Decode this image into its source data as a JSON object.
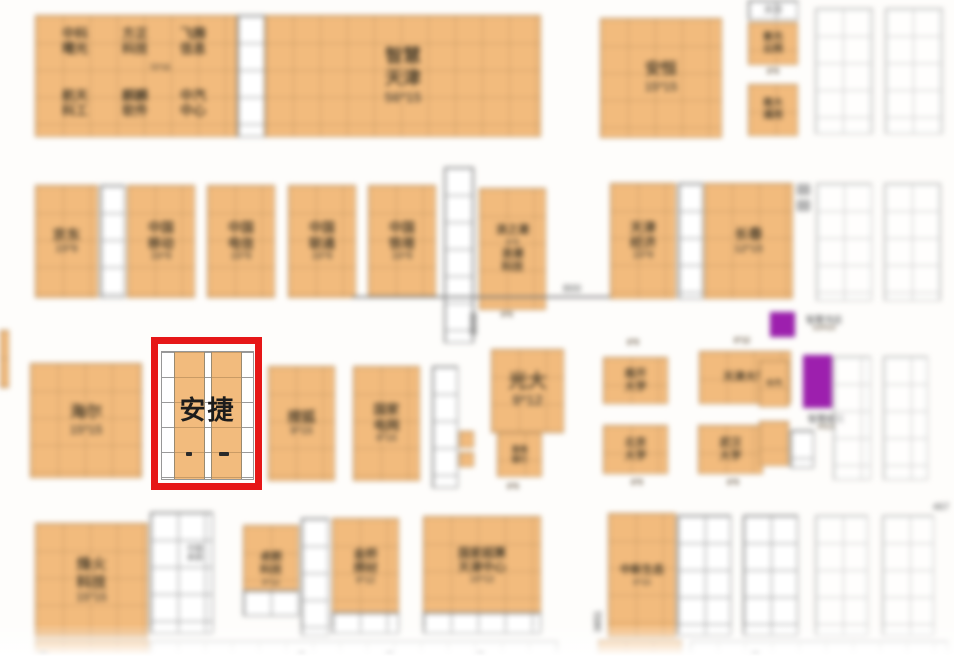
{
  "title": "exhibition-floor-plan",
  "highlight": {
    "company": "安捷",
    "frame_color": "#e61717"
  },
  "colors": {
    "booth_orange": "#f2bb7d",
    "empty_white": "#ffffff",
    "service_purple": "#9d1fae",
    "highlight_red": "#e61717",
    "label_dark": "#50432f",
    "dim_gray": "#8b8b8b"
  },
  "booths": [
    {
      "id": "group-topleft",
      "kind": "orange",
      "x": 35,
      "y": 15,
      "w": 202,
      "h": 122,
      "fs": 13,
      "lines": []
    },
    {
      "id": "band-topleft",
      "kind": "txt",
      "x": 100,
      "y": 60,
      "w": 120,
      "h": 16,
      "fs": 10,
      "cls": "gray-t",
      "lines": [
        "72*15"
      ]
    },
    {
      "id": "zhongke-shuguang",
      "kind": "txt",
      "x": 52,
      "y": 20,
      "w": 46,
      "h": 42,
      "fs": 13,
      "lines": [
        "中科",
        "曙光"
      ]
    },
    {
      "id": "fangzheng-keji",
      "kind": "txt",
      "x": 112,
      "y": 20,
      "w": 46,
      "h": 42,
      "fs": 13,
      "lines": [
        "方正",
        "科技"
      ]
    },
    {
      "id": "feiteng-xinxi",
      "kind": "txt",
      "x": 168,
      "y": 20,
      "w": 50,
      "h": 42,
      "fs": 13,
      "lines": [
        "飞腾",
        "信息"
      ]
    },
    {
      "id": "hangtian-kegong",
      "kind": "txt",
      "x": 52,
      "y": 82,
      "w": 46,
      "h": 42,
      "fs": 13,
      "lines": [
        "航天",
        "科工"
      ]
    },
    {
      "id": "qilin-ruanjian",
      "kind": "txt",
      "x": 112,
      "y": 82,
      "w": 46,
      "h": 42,
      "fs": 13,
      "lines": [
        "麒麟",
        "软件"
      ]
    },
    {
      "id": "zhongqi-zhongxin",
      "kind": "txt",
      "x": 168,
      "y": 82,
      "w": 50,
      "h": 42,
      "fs": 13,
      "lines": [
        "中汽",
        "中心"
      ]
    },
    {
      "id": "empty-col-1",
      "kind": "white",
      "x": 237,
      "y": 15,
      "w": 28,
      "h": 122,
      "lines": []
    },
    {
      "id": "zhihui-tianjin",
      "kind": "orange",
      "x": 265,
      "y": 15,
      "w": 276,
      "h": 122,
      "fs": 18,
      "lines": [
        "智慧",
        "天津",
        "56*15"
      ]
    },
    {
      "id": "anheng",
      "kind": "orange",
      "x": 600,
      "y": 18,
      "w": 122,
      "h": 120,
      "fs": 16,
      "lines": [
        "安恒",
        "15*15"
      ]
    },
    {
      "id": "tianhe",
      "kind": "white",
      "x": 748,
      "y": 0,
      "w": 50,
      "h": 20,
      "fs": 9,
      "cls": "gray-t",
      "lines": [
        "天河"
      ]
    },
    {
      "id": "ziguang-yunwang",
      "kind": "orange",
      "x": 748,
      "y": 22,
      "w": 50,
      "h": 43,
      "fs": 10,
      "lines": [
        "紫光",
        "云网"
      ]
    },
    {
      "id": "label-6x9-top",
      "kind": "txt",
      "x": 756,
      "y": 64,
      "w": 34,
      "h": 16,
      "fs": 10,
      "cls": "gray-t",
      "lines": [
        "6*9"
      ]
    },
    {
      "id": "nanda-tongyong",
      "kind": "orange",
      "x": 748,
      "y": 84,
      "w": 50,
      "h": 52,
      "fs": 10,
      "lines": [
        "南大",
        "通用"
      ]
    },
    {
      "id": "empty-top-1",
      "kind": "white faded",
      "x": 815,
      "y": 8,
      "w": 58,
      "h": 126,
      "lines": []
    },
    {
      "id": "empty-top-2",
      "kind": "white faded",
      "x": 885,
      "y": 8,
      "w": 58,
      "h": 126,
      "lines": []
    },
    {
      "id": "jingdong",
      "kind": "orange",
      "x": 35,
      "y": 185,
      "w": 63,
      "h": 113,
      "fs": 14,
      "lines": [
        "京东",
        "15*9"
      ]
    },
    {
      "id": "empty-col-2",
      "kind": "white",
      "x": 100,
      "y": 185,
      "w": 25,
      "h": 113,
      "lines": []
    },
    {
      "id": "china-mobile",
      "kind": "orange",
      "x": 127,
      "y": 185,
      "w": 68,
      "h": 113,
      "fs": 13,
      "lines": [
        "中国",
        "移动",
        "15*9"
      ]
    },
    {
      "id": "china-telecom",
      "kind": "orange",
      "x": 207,
      "y": 185,
      "w": 68,
      "h": 113,
      "fs": 13,
      "lines": [
        "中国",
        "电信",
        "15*9"
      ]
    },
    {
      "id": "china-unicom",
      "kind": "orange",
      "x": 288,
      "y": 185,
      "w": 68,
      "h": 113,
      "fs": 13,
      "lines": [
        "中国",
        "联通",
        "15*9"
      ]
    },
    {
      "id": "china-tower",
      "kind": "orange",
      "x": 368,
      "y": 185,
      "w": 68,
      "h": 113,
      "fs": 13,
      "lines": [
        "中国",
        "铁塔",
        "15*9"
      ]
    },
    {
      "id": "ladder-1",
      "kind": "white",
      "x": 444,
      "y": 167,
      "w": 30,
      "h": 176,
      "lines": []
    },
    {
      "id": "langchao",
      "kind": "orange",
      "x": 479,
      "y": 188,
      "w": 67,
      "h": 122,
      "fs": 11,
      "lines": [
        "浪之潮",
        "6*9",
        "浪潮",
        "科技"
      ]
    },
    {
      "id": "label-6x6-a",
      "kind": "txt",
      "x": 492,
      "y": 308,
      "w": 30,
      "h": 14,
      "fs": 10,
      "cls": "gray-t",
      "lines": [
        "6*6"
      ]
    },
    {
      "id": "dim-line-800",
      "kind": "hline",
      "x": 352,
      "y": 296,
      "w": 276,
      "h": 2,
      "lines": []
    },
    {
      "id": "dim-800",
      "kind": "txt",
      "x": 556,
      "y": 283,
      "w": 32,
      "h": 12,
      "fs": 11,
      "cls": "gray-t",
      "lines": [
        "800"
      ]
    },
    {
      "id": "dim-8000",
      "kind": "vtext",
      "x": 468,
      "y": 300,
      "w": 14,
      "h": 48,
      "lines": [
        "8000"
      ]
    },
    {
      "id": "tianjin-jingji",
      "kind": "orange",
      "x": 610,
      "y": 183,
      "w": 66,
      "h": 116,
      "fs": 13,
      "lines": [
        "天津",
        "经济",
        "15*9"
      ]
    },
    {
      "id": "empty-col-3",
      "kind": "white",
      "x": 678,
      "y": 183,
      "w": 25,
      "h": 116,
      "lines": []
    },
    {
      "id": "changchun",
      "kind": "orange",
      "x": 704,
      "y": 183,
      "w": 89,
      "h": 116,
      "fs": 14,
      "lines": [
        "长春",
        "12*15"
      ]
    },
    {
      "id": "tiny-gray-1",
      "kind": "grayblk",
      "x": 797,
      "y": 184,
      "w": 13,
      "h": 11,
      "lines": []
    },
    {
      "id": "tiny-gray-2",
      "kind": "grayblk",
      "x": 797,
      "y": 200,
      "w": 13,
      "h": 11,
      "lines": []
    },
    {
      "id": "empty-mid-1",
      "kind": "white faded",
      "x": 816,
      "y": 183,
      "w": 56,
      "h": 118,
      "lines": []
    },
    {
      "id": "empty-mid-2",
      "kind": "white faded",
      "x": 884,
      "y": 183,
      "w": 57,
      "h": 118,
      "lines": []
    },
    {
      "id": "edge-sliver",
      "kind": "orange",
      "x": 0,
      "y": 330,
      "w": 9,
      "h": 58,
      "lines": []
    },
    {
      "id": "haier",
      "kind": "orange",
      "x": 30,
      "y": 363,
      "w": 112,
      "h": 115,
      "fs": 16,
      "lines": [
        "海尔",
        "15*15"
      ]
    },
    {
      "id": "souhu",
      "kind": "orange",
      "x": 268,
      "y": 366,
      "w": 67,
      "h": 115,
      "fs": 14,
      "lines": [
        "搜狐",
        "9*15"
      ]
    },
    {
      "id": "guojia-dianwang",
      "kind": "orange",
      "x": 353,
      "y": 366,
      "w": 67,
      "h": 115,
      "fs": 13,
      "lines": [
        "国家",
        "电网",
        "9*15"
      ]
    },
    {
      "id": "ladder-2",
      "kind": "white",
      "x": 432,
      "y": 366,
      "w": 26,
      "h": 122,
      "lines": []
    },
    {
      "id": "small-booth-1",
      "kind": "orange",
      "x": 459,
      "y": 431,
      "w": 15,
      "h": 17,
      "lines": []
    },
    {
      "id": "small-booth-2",
      "kind": "orange",
      "x": 459,
      "y": 452,
      "w": 15,
      "h": 15,
      "lines": []
    },
    {
      "id": "guangda",
      "kind": "orange",
      "x": 491,
      "y": 349,
      "w": 73,
      "h": 84,
      "fs": 19,
      "lines": [
        "光大",
        "9*12"
      ]
    },
    {
      "id": "guangda-sub",
      "kind": "orange",
      "x": 497,
      "y": 432,
      "w": 45,
      "h": 45,
      "fs": 8,
      "lines": [
        "渤海",
        "银行"
      ]
    },
    {
      "id": "label-6x6-b",
      "kind": "txt",
      "x": 498,
      "y": 480,
      "w": 30,
      "h": 13,
      "fs": 10,
      "cls": "gray-t",
      "lines": [
        "6*6"
      ]
    },
    {
      "id": "label-6x9-a",
      "kind": "txt",
      "x": 618,
      "y": 336,
      "w": 30,
      "h": 13,
      "fs": 10,
      "cls": "gray-t",
      "lines": [
        "6*9"
      ]
    },
    {
      "id": "nankai-daxue",
      "kind": "orange",
      "x": 603,
      "y": 357,
      "w": 65,
      "h": 47,
      "fs": 11,
      "lines": [
        "南开",
        "大学"
      ]
    },
    {
      "id": "label-6x12",
      "kind": "txt",
      "x": 724,
      "y": 334,
      "w": 36,
      "h": 13,
      "fs": 10,
      "cls": "gray-t",
      "lines": [
        "6*12"
      ]
    },
    {
      "id": "tianjin-daxue",
      "kind": "orange",
      "x": 699,
      "y": 351,
      "w": 92,
      "h": 53,
      "fs": 11,
      "lines": [
        "天津大学"
      ]
    },
    {
      "id": "beijing-daxue",
      "kind": "orange",
      "x": 603,
      "y": 425,
      "w": 65,
      "h": 49,
      "fs": 11,
      "lines": [
        "北京",
        "大学"
      ]
    },
    {
      "id": "label-6x9-b",
      "kind": "txt",
      "x": 622,
      "y": 476,
      "w": 30,
      "h": 13,
      "fs": 10,
      "cls": "gray-t",
      "lines": [
        "6*9"
      ]
    },
    {
      "id": "wuhan-daxue",
      "kind": "orange",
      "x": 698,
      "y": 425,
      "w": 65,
      "h": 49,
      "fs": 11,
      "lines": [
        "武汉",
        "大学"
      ]
    },
    {
      "id": "label-6x9-c",
      "kind": "txt",
      "x": 718,
      "y": 476,
      "w": 30,
      "h": 13,
      "fs": 10,
      "cls": "gray-t",
      "lines": [
        "6*9"
      ]
    },
    {
      "id": "zhongqi-east",
      "kind": "orange",
      "x": 759,
      "y": 360,
      "w": 30,
      "h": 47,
      "fs": 8,
      "lines": [
        "中汽"
      ]
    },
    {
      "id": "east-sub",
      "kind": "orange",
      "x": 759,
      "y": 421,
      "w": 30,
      "h": 45,
      "lines": []
    },
    {
      "id": "purple-bookstore",
      "kind": "purple",
      "x": 770,
      "y": 312,
      "w": 25,
      "h": 25,
      "lines": []
    },
    {
      "id": "bookstore-label",
      "kind": "txt",
      "x": 797,
      "y": 310,
      "w": 54,
      "h": 28,
      "fs": 9,
      "cls": "gray-t",
      "lines": [
        "智慧书店",
        "3.5*3.5"
      ]
    },
    {
      "id": "purple-post",
      "kind": "purple",
      "x": 803,
      "y": 355,
      "w": 29,
      "h": 53,
      "lines": []
    },
    {
      "id": "post-label",
      "kind": "txt",
      "x": 800,
      "y": 409,
      "w": 52,
      "h": 28,
      "fs": 9,
      "cls": "gray-t",
      "lines": [
        "智慧邮局",
        "4*2.5"
      ]
    },
    {
      "id": "small-white",
      "kind": "white",
      "x": 790,
      "y": 430,
      "w": 24,
      "h": 38,
      "lines": []
    },
    {
      "id": "empty-r3-1",
      "kind": "white faded",
      "x": 833,
      "y": 356,
      "w": 38,
      "h": 124,
      "lines": []
    },
    {
      "id": "empty-r3-2",
      "kind": "white faded",
      "x": 883,
      "y": 356,
      "w": 45,
      "h": 124,
      "lines": []
    },
    {
      "id": "fenghuo-keji",
      "kind": "orange",
      "x": 35,
      "y": 523,
      "w": 113,
      "h": 115,
      "fs": 15,
      "lines": [
        "烽火",
        "科技",
        "15*15"
      ]
    },
    {
      "id": "empty-b1",
      "kind": "white",
      "x": 150,
      "y": 512,
      "w": 63,
      "h": 122,
      "lines": []
    },
    {
      "id": "zhongguo-xitong",
      "kind": "txt",
      "x": 174,
      "y": 539,
      "w": 42,
      "h": 28,
      "fs": 8,
      "cls": "gray-t",
      "lines": [
        "中国",
        "系统"
      ]
    },
    {
      "id": "zhuolang-keji",
      "kind": "orange",
      "x": 243,
      "y": 525,
      "w": 56,
      "h": 88,
      "fs": 11,
      "lines": [
        "卓朗",
        "科技",
        "9*12"
      ]
    },
    {
      "id": "zhuolang-sub",
      "kind": "white",
      "x": 243,
      "y": 590,
      "w": 56,
      "h": 26,
      "lines": []
    },
    {
      "id": "empty-col-4",
      "kind": "white",
      "x": 301,
      "y": 518,
      "w": 28,
      "h": 118,
      "lines": []
    },
    {
      "id": "jinqiao-hancai",
      "kind": "orange",
      "x": 332,
      "y": 518,
      "w": 67,
      "h": 97,
      "fs": 12,
      "lines": [
        "金桥",
        "焊材",
        "9*12"
      ]
    },
    {
      "id": "jinqiao-sub",
      "kind": "white",
      "x": 332,
      "y": 612,
      "w": 67,
      "h": 22,
      "lines": []
    },
    {
      "id": "guojia-chaosuan",
      "kind": "orange",
      "x": 423,
      "y": 516,
      "w": 118,
      "h": 99,
      "fs": 12,
      "lines": [
        "国家超算",
        "天津中心",
        "15*12"
      ]
    },
    {
      "id": "chaosuan-sub",
      "kind": "white",
      "x": 423,
      "y": 612,
      "w": 118,
      "h": 22,
      "lines": []
    },
    {
      "id": "dim-3651",
      "kind": "vtext",
      "x": 592,
      "y": 596,
      "w": 14,
      "h": 52,
      "lines": [
        "3651"
      ]
    },
    {
      "id": "zhongxin-shengtai",
      "kind": "orange",
      "x": 608,
      "y": 513,
      "w": 68,
      "h": 125,
      "fs": 11,
      "lines": [
        "中新生态",
        "9*15"
      ]
    },
    {
      "id": "empty-b2",
      "kind": "white",
      "x": 677,
      "y": 515,
      "w": 54,
      "h": 121,
      "lines": []
    },
    {
      "id": "empty-b3",
      "kind": "white",
      "x": 743,
      "y": 515,
      "w": 55,
      "h": 121,
      "lines": []
    },
    {
      "id": "empty-b4",
      "kind": "white faded",
      "x": 815,
      "y": 515,
      "w": 53,
      "h": 121,
      "lines": []
    },
    {
      "id": "empty-b5",
      "kind": "white faded",
      "x": 882,
      "y": 515,
      "w": 52,
      "h": 121,
      "lines": []
    },
    {
      "id": "dim-467",
      "kind": "txt",
      "x": 928,
      "y": 501,
      "w": 26,
      "h": 13,
      "fs": 10,
      "cls": "gray-t",
      "lines": [
        "467"
      ]
    },
    {
      "id": "fade-orange-1",
      "kind": "orange",
      "x": 35,
      "y": 640,
      "w": 114,
      "h": 24,
      "lines": []
    },
    {
      "id": "fade-white-1",
      "kind": "white faded",
      "x": 150,
      "y": 641,
      "w": 408,
      "h": 23,
      "lines": []
    },
    {
      "id": "fade-orange-2",
      "kind": "orange",
      "x": 598,
      "y": 640,
      "w": 84,
      "h": 24,
      "lines": []
    },
    {
      "id": "fade-white-2",
      "kind": "white faded",
      "x": 690,
      "y": 641,
      "w": 258,
      "h": 23,
      "lines": []
    },
    {
      "id": "tick-1",
      "kind": "tick",
      "x": 40,
      "y": 652,
      "w": 7,
      "h": 9,
      "lines": []
    },
    {
      "id": "tick-2",
      "kind": "tick",
      "x": 298,
      "y": 652,
      "w": 7,
      "h": 9,
      "lines": []
    },
    {
      "id": "tick-3",
      "kind": "tick",
      "x": 386,
      "y": 652,
      "w": 7,
      "h": 9,
      "lines": []
    },
    {
      "id": "tick-4",
      "kind": "tick",
      "x": 477,
      "y": 652,
      "w": 7,
      "h": 9,
      "lines": []
    },
    {
      "id": "tick-5",
      "kind": "tick",
      "x": 752,
      "y": 652,
      "w": 7,
      "h": 9,
      "lines": []
    }
  ]
}
